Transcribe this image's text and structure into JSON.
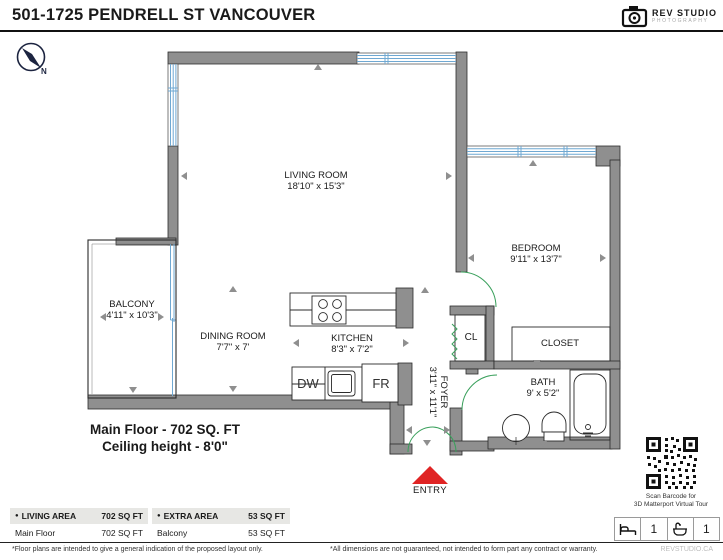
{
  "header": {
    "title": "501-1725 PENDRELL ST VANCOUVER",
    "logo": {
      "name": "REV STUDIO",
      "sub": "PHOTOGRAPHY"
    }
  },
  "compass": {
    "label": "N"
  },
  "floor_plan": {
    "rooms": [
      {
        "name": "LIVING ROOM",
        "dims": "18'10\" x 15'3\""
      },
      {
        "name": "BEDROOM",
        "dims": "9'11\" x 13'7\""
      },
      {
        "name": "BALCONY",
        "dims": "4'11\" x 10'3\""
      },
      {
        "name": "DINING ROOM",
        "dims": "7'7\" x 7'"
      },
      {
        "name": "KITCHEN",
        "dims": "8'3\" x 7'2\""
      },
      {
        "name": "FOYER",
        "dims": "3'11\" x 11'1\""
      },
      {
        "name": "BATH",
        "dims": "9' x 5'2\""
      }
    ],
    "labels": {
      "cl": "CL",
      "closet": "CLOSET",
      "dw": "DW",
      "fr": "FR",
      "entry": "ENTRY"
    },
    "floor_title": "Main Floor - 702 SQ. FT",
    "ceiling": "Ceiling height - 8'0\""
  },
  "area_tables": [
    {
      "header": {
        "bullet": "●",
        "label": "LIVING AREA",
        "value": "702 SQ FT"
      },
      "rows": [
        {
          "label": "Main Floor",
          "value": "702 SQ FT"
        }
      ]
    },
    {
      "header": {
        "bullet": "●",
        "label": "EXTRA AREA",
        "value": "53 SQ FT"
      },
      "rows": [
        {
          "label": "Balcony",
          "value": "53 SQ FT"
        }
      ]
    }
  ],
  "sidebar": {
    "qr_caption_line1": "Scan Barcode for",
    "qr_caption_line2": "3D Matterport Virtual Tour",
    "beds": "1",
    "baths": "1"
  },
  "footer": {
    "left": "*Floor plans are intended to give a general indication of the proposed layout only.",
    "center": "*All dimensions are not guaranteed, not intended to form part any contract or warranty.",
    "right": "REVSTUDIO.CA"
  },
  "colors": {
    "wall": "#8f8f8f",
    "window": "#6fa8d2",
    "door": "#3aa05c",
    "entry_arrow": "#e02424"
  }
}
